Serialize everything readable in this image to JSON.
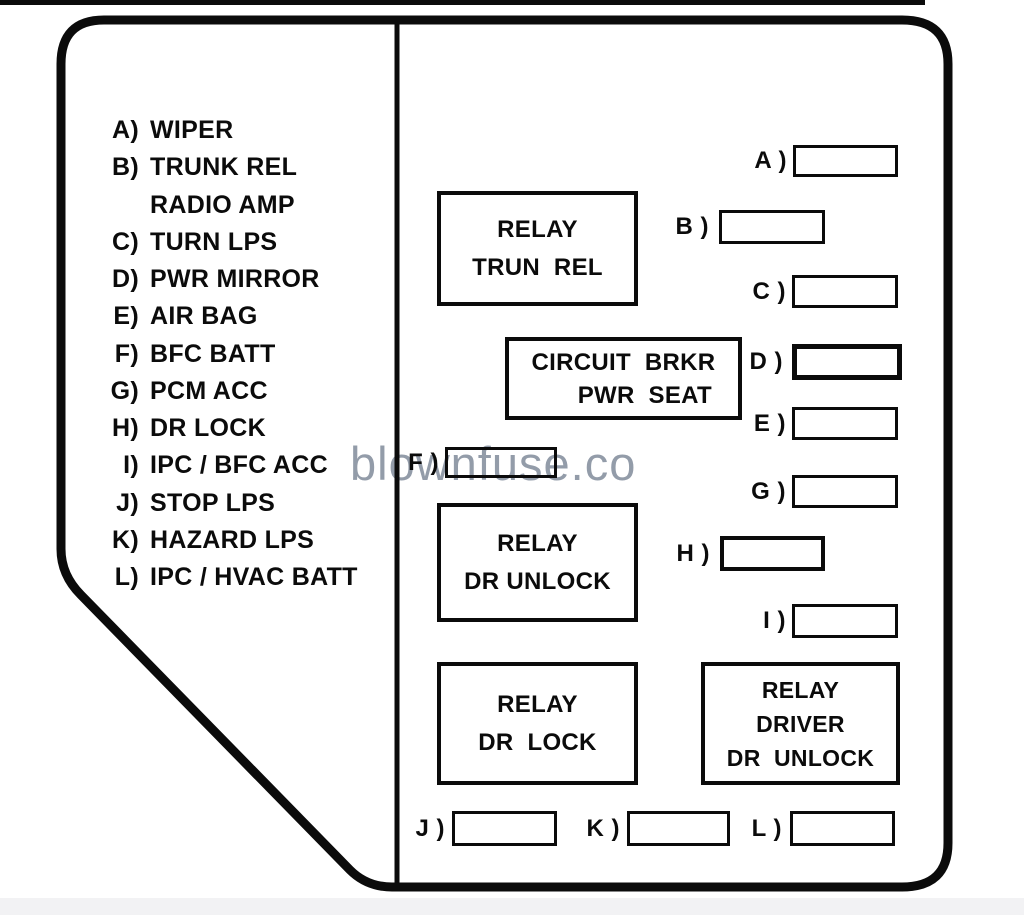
{
  "watermark": "blownfuse.co",
  "colors": {
    "ink": "#0b0b0b",
    "watermark_gray": "#939ca9",
    "page_strip": "#f2f2f4",
    "background": "#ffffff"
  },
  "legend": {
    "items": [
      {
        "key": "A)",
        "label": "WIPER"
      },
      {
        "key": "B)",
        "label": "TRUNK REL"
      },
      {
        "key": "",
        "label": "RADIO AMP"
      },
      {
        "key": "C)",
        "label": "TURN LPS"
      },
      {
        "key": "D)",
        "label": "PWR MIRROR"
      },
      {
        "key": "E)",
        "label": "AIR BAG"
      },
      {
        "key": "F)",
        "label": "BFC BATT"
      },
      {
        "key": "G)",
        "label": "PCM ACC"
      },
      {
        "key": "H)",
        "label": "DR LOCK"
      },
      {
        "key": "I)",
        "label": "IPC / BFC ACC"
      },
      {
        "key": "J)",
        "label": "STOP LPS"
      },
      {
        "key": "K)",
        "label": "HAZARD LPS"
      },
      {
        "key": "L)",
        "label": "IPC / HVAC BATT"
      }
    ]
  },
  "relays": [
    {
      "name": "relay-trunk-release",
      "lines": [
        "RELAY",
        "TRUN  REL"
      ]
    },
    {
      "name": "circuit-breaker-power-seat",
      "lines": [
        "CIRCUIT  BRKR",
        "PWR  SEAT"
      ]
    },
    {
      "name": "relay-door-unlock",
      "lines": [
        "RELAY",
        "DR UNLOCK"
      ]
    },
    {
      "name": "relay-door-lock",
      "lines": [
        "RELAY",
        "DR  LOCK"
      ]
    },
    {
      "name": "relay-driver-door-unlock",
      "lines": [
        "RELAY",
        "DRIVER",
        "DR  UNLOCK"
      ]
    }
  ],
  "fuse_slots": [
    {
      "label": "A )"
    },
    {
      "label": "B )"
    },
    {
      "label": "C )"
    },
    {
      "label": "D )"
    },
    {
      "label": "E )"
    },
    {
      "label": "F )"
    },
    {
      "label": "G )"
    },
    {
      "label": "H )"
    },
    {
      "label": "I )"
    },
    {
      "label": "J )"
    },
    {
      "label": "K )"
    },
    {
      "label": "L )"
    }
  ]
}
